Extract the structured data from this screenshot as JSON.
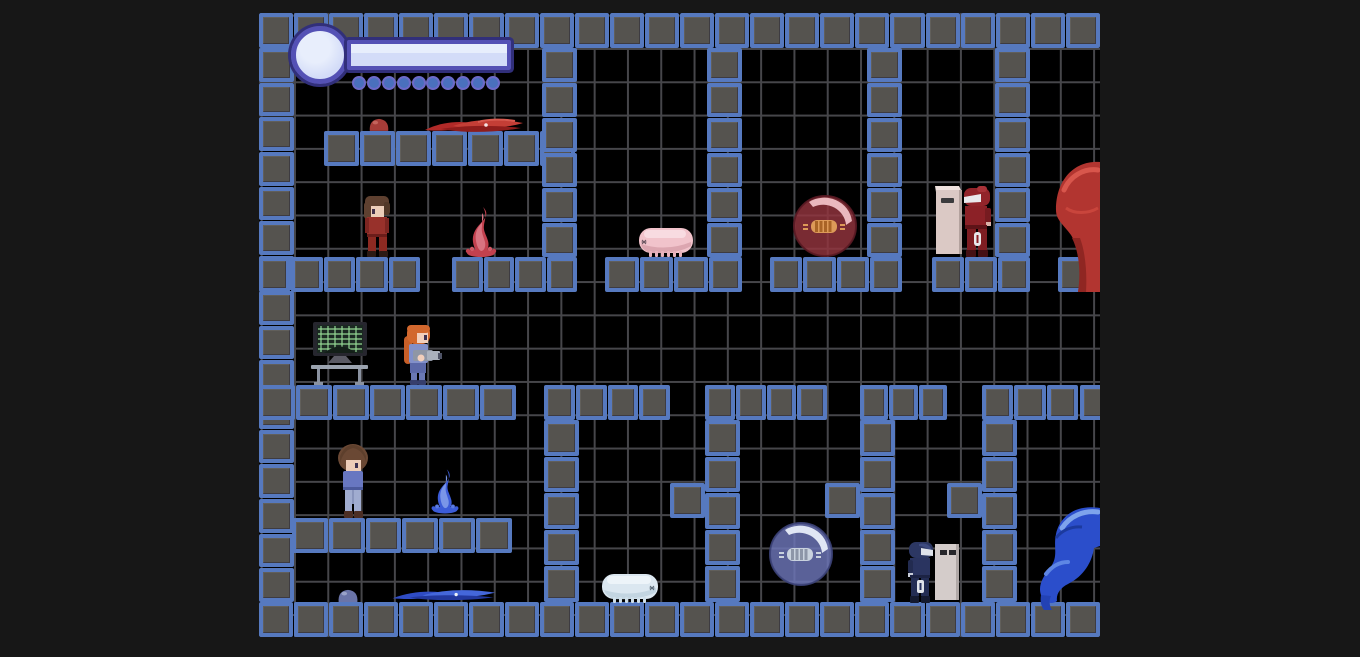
{
  "window": {
    "title": "platformer-game",
    "width": 1360,
    "height": 657
  },
  "scene": {
    "game_area": {
      "x": 259,
      "y": 13,
      "w": 841,
      "h": 624
    },
    "grid_pitch_px": 33.3,
    "tile_size_px": 35
  },
  "palette": {
    "outer_bg": "#171717",
    "game_bg": "#000000",
    "grid_line": "#46464a",
    "tile_fill": "#55534f",
    "tile_border": "#5679bf",
    "hud_frame": "#5451b5",
    "hud_frame_outline": "#312f7a",
    "hud_fill": "#d3dcf8",
    "hud_dot": "#4a70bd",
    "red_team": "#a5302c",
    "blue_team": "#2f4fc0"
  },
  "hud": {
    "orb": {
      "x": 291,
      "y": 26,
      "d": 58
    },
    "bar": {
      "x": 347,
      "y": 40,
      "w": 164,
      "h": 30,
      "fill_ratio": 1.0
    },
    "dots": {
      "count": 10
    },
    "dots_rect": {
      "x": 352,
      "y": 75,
      "w": 148,
      "h": 15
    }
  },
  "structures": [
    {
      "name": "wall-top",
      "x": 259,
      "y": 13,
      "w": 841,
      "h": 35,
      "cols": 24,
      "rows": 1
    },
    {
      "name": "wall-bottom",
      "x": 259,
      "y": 602,
      "w": 841,
      "h": 35,
      "cols": 24,
      "rows": 1
    },
    {
      "name": "wall-left",
      "x": 259,
      "y": 48,
      "w": 35,
      "h": 554,
      "cols": 1,
      "rows": 16
    },
    {
      "name": "platform-hud",
      "x": 324,
      "y": 131,
      "w": 251,
      "h": 35,
      "cols": 7,
      "rows": 1
    },
    {
      "name": "platform-upper-left",
      "x": 259,
      "y": 257,
      "w": 161,
      "h": 35,
      "cols": 5,
      "rows": 1
    },
    {
      "name": "platform-flame-red",
      "x": 452,
      "y": 257,
      "w": 125,
      "h": 35,
      "cols": 4,
      "rows": 1
    },
    {
      "name": "wall-upper-1",
      "x": 542,
      "y": 48,
      "w": 35,
      "h": 209,
      "cols": 1,
      "rows": 6
    },
    {
      "name": "platform-pig",
      "x": 605,
      "y": 257,
      "w": 137,
      "h": 35,
      "cols": 4,
      "rows": 1
    },
    {
      "name": "wall-upper-2",
      "x": 707,
      "y": 48,
      "w": 35,
      "h": 209,
      "cols": 1,
      "rows": 6
    },
    {
      "name": "platform-bubble-red",
      "x": 770,
      "y": 257,
      "w": 132,
      "h": 35,
      "cols": 4,
      "rows": 1
    },
    {
      "name": "wall-upper-3",
      "x": 867,
      "y": 48,
      "w": 35,
      "h": 209,
      "cols": 1,
      "rows": 6
    },
    {
      "name": "platform-soldier-red",
      "x": 932,
      "y": 257,
      "w": 98,
      "h": 35,
      "cols": 3,
      "rows": 1
    },
    {
      "name": "wall-upper-4",
      "x": 995,
      "y": 48,
      "w": 35,
      "h": 209,
      "cols": 1,
      "rows": 6
    },
    {
      "name": "platform-blob-red",
      "x": 1058,
      "y": 257,
      "w": 70,
      "h": 35,
      "cols": 2,
      "rows": 1
    },
    {
      "name": "platform-mid-left",
      "x": 259,
      "y": 385,
      "w": 257,
      "h": 35,
      "cols": 7,
      "rows": 1
    },
    {
      "name": "platform-gamma1",
      "x": 544,
      "y": 385,
      "w": 126,
      "h": 35,
      "cols": 4,
      "rows": 1
    },
    {
      "name": "wall-gamma1",
      "x": 544,
      "y": 420,
      "w": 35,
      "h": 182,
      "cols": 1,
      "rows": 5
    },
    {
      "name": "platform-gamma2",
      "x": 705,
      "y": 385,
      "w": 122,
      "h": 35,
      "cols": 4,
      "rows": 1
    },
    {
      "name": "wall-gamma2",
      "x": 705,
      "y": 420,
      "w": 35,
      "h": 182,
      "cols": 1,
      "rows": 5
    },
    {
      "name": "block-mid-1",
      "x": 670,
      "y": 483,
      "w": 35,
      "h": 35,
      "cols": 1,
      "rows": 1
    },
    {
      "name": "platform-gamma3",
      "x": 860,
      "y": 385,
      "w": 87,
      "h": 35,
      "cols": 3,
      "rows": 1
    },
    {
      "name": "wall-gamma3",
      "x": 860,
      "y": 420,
      "w": 35,
      "h": 182,
      "cols": 1,
      "rows": 5
    },
    {
      "name": "block-mid-2",
      "x": 825,
      "y": 483,
      "w": 35,
      "h": 35,
      "cols": 1,
      "rows": 1
    },
    {
      "name": "platform-gamma4",
      "x": 982,
      "y": 385,
      "w": 96,
      "h": 35,
      "cols": 3,
      "rows": 1
    },
    {
      "name": "wall-gamma4",
      "x": 982,
      "y": 420,
      "w": 35,
      "h": 182,
      "cols": 1,
      "rows": 5
    },
    {
      "name": "block-mid-3",
      "x": 947,
      "y": 483,
      "w": 35,
      "h": 35,
      "cols": 1,
      "rows": 1
    },
    {
      "name": "platform-right-edge",
      "x": 1080,
      "y": 385,
      "w": 35,
      "h": 35,
      "cols": 1,
      "rows": 1
    },
    {
      "name": "platform-lower-left",
      "x": 292,
      "y": 518,
      "w": 220,
      "h": 35,
      "cols": 6,
      "rows": 1
    }
  ],
  "entities": {
    "slime_red": {
      "x": 368,
      "y": 115,
      "w": 22,
      "h": 17
    },
    "tentacles_red": {
      "x": 423,
      "y": 117,
      "w": 102,
      "h": 17
    },
    "player_red": {
      "x": 360,
      "y": 195,
      "w": 34,
      "h": 62
    },
    "flame_red": {
      "x": 464,
      "y": 205,
      "w": 34,
      "h": 52
    },
    "caterpillar_pink": {
      "x": 636,
      "y": 226,
      "w": 60,
      "h": 32
    },
    "bubble_red": {
      "x": 792,
      "y": 195,
      "w": 66,
      "h": 63
    },
    "soldier_red": {
      "x": 934,
      "y": 184,
      "w": 64,
      "h": 74
    },
    "blob_red": {
      "x": 1050,
      "y": 156,
      "w": 50,
      "h": 136
    },
    "monitor_station": {
      "x": 310,
      "y": 322,
      "w": 60,
      "h": 63
    },
    "gunner_blue": {
      "x": 394,
      "y": 324,
      "w": 49,
      "h": 61
    },
    "player_blue": {
      "x": 337,
      "y": 444,
      "w": 32,
      "h": 74
    },
    "flame_blue": {
      "x": 430,
      "y": 463,
      "w": 30,
      "h": 55
    },
    "slime_blue": {
      "x": 336,
      "y": 587,
      "w": 24,
      "h": 15
    },
    "tentacles_blue": {
      "x": 387,
      "y": 588,
      "w": 114,
      "h": 14
    },
    "caterpillar_white": {
      "x": 599,
      "y": 573,
      "w": 62,
      "h": 31
    },
    "bubble_blue": {
      "x": 768,
      "y": 521,
      "w": 66,
      "h": 66
    },
    "soldier_blue": {
      "x": 905,
      "y": 540,
      "w": 58,
      "h": 64
    },
    "blob_blue": {
      "x": 1032,
      "y": 504,
      "w": 68,
      "h": 106
    }
  }
}
